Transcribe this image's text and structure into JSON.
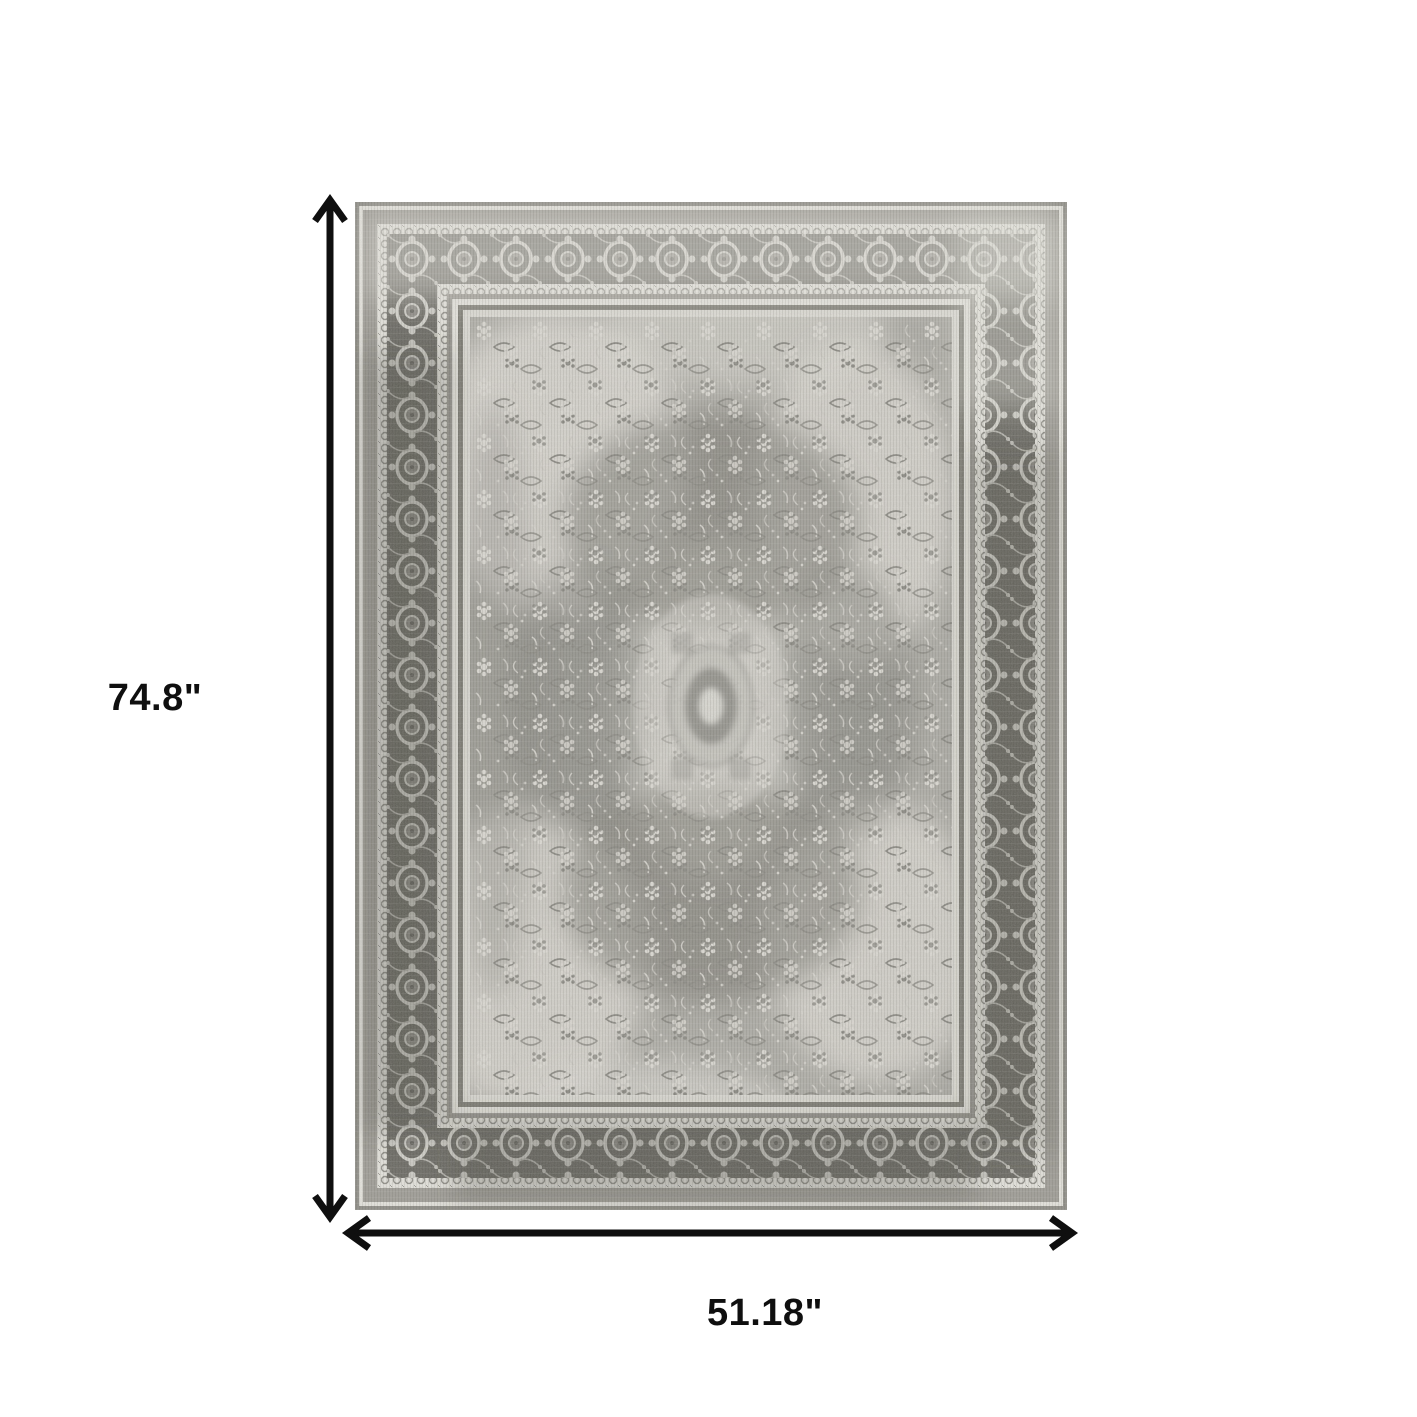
{
  "figure": {
    "height_label": "74.8\"",
    "width_label": "51.18\""
  },
  "colors": {
    "canvas-bg": "#ffffff",
    "dimension-ink": "#0f0f0f",
    "rug-selvedge": "#908f89",
    "rug-band-light": "#e8e7e1",
    "rug-band-gray": "#a19f99",
    "rug-border-dark": "#6b6a64",
    "rug-field": "#b0afa9",
    "rug-motif-light": "#d6d5cf",
    "rug-motif-dark": "#8c8b85"
  }
}
